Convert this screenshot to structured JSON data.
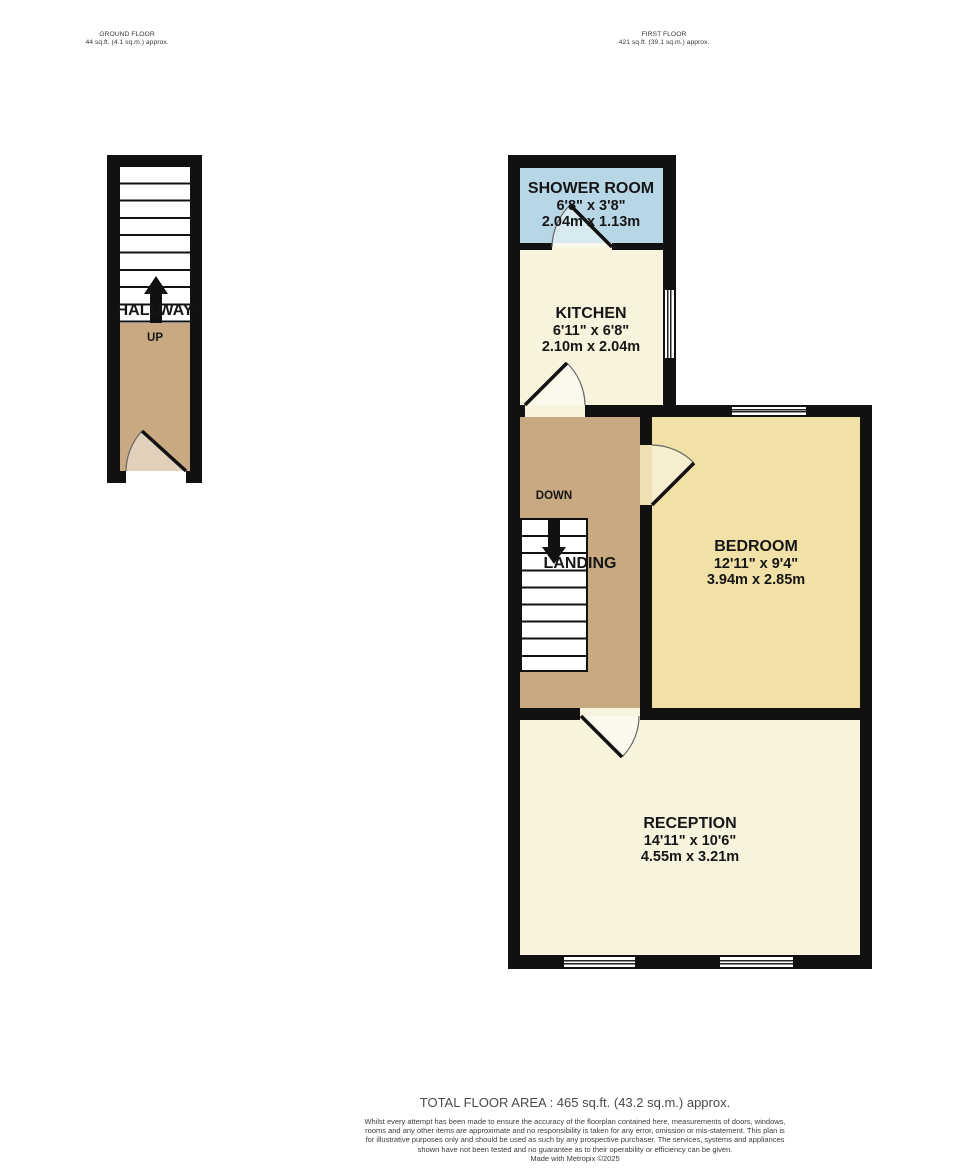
{
  "floors": {
    "ground": {
      "title": "GROUND FLOOR",
      "area": "44 sq.ft. (4.1 sq.m.) approx."
    },
    "first": {
      "title": "FIRST FLOOR",
      "area": "421 sq.ft. (39.1 sq.m.) approx."
    }
  },
  "rooms": {
    "hallway": {
      "name": "HALLWAY",
      "stair_direction": "UP"
    },
    "shower_room": {
      "name": "SHOWER ROOM",
      "imperial": "6'8\" x 3'8\"",
      "metric": "2.04m x 1.13m"
    },
    "kitchen": {
      "name": "KITCHEN",
      "imperial": "6'11\" x 6'8\"",
      "metric": "2.10m x 2.04m"
    },
    "landing": {
      "name": "LANDING",
      "stair_direction": "DOWN"
    },
    "bedroom": {
      "name": "BEDROOM",
      "imperial": "12'11\" x 9'4\"",
      "metric": "3.94m x 2.85m"
    },
    "reception": {
      "name": "RECEPTION",
      "imperial": "14'11\" x 10'6\"",
      "metric": "4.55m x 3.21m"
    }
  },
  "footer": {
    "total_area": "TOTAL FLOOR AREA : 465 sq.ft. (43.2 sq.m.) approx.",
    "disclaimer": "Whilst every attempt has been made to ensure the accuracy of the floorplan contained here, measurements of doors, windows, rooms and any other items are approximate and no responsibility is taken for any error, omission or mis-statement. This plan is for illustrative purposes only and should be used as such by any prospective purchaser. The services, systems and appliances shown have not been tested and no guarantee as to their operability or efficiency can be given.",
    "credit": "Made with Metropix ©2025"
  },
  "colors": {
    "wall": "#111111",
    "hallway_floor": "#c8a981",
    "landing_floor": "#c8a981",
    "shower_room": "#b7d7e6",
    "kitchen": "#f8f3dc",
    "reception": "#f8f3dc",
    "bedroom": "#f1e1a6"
  }
}
